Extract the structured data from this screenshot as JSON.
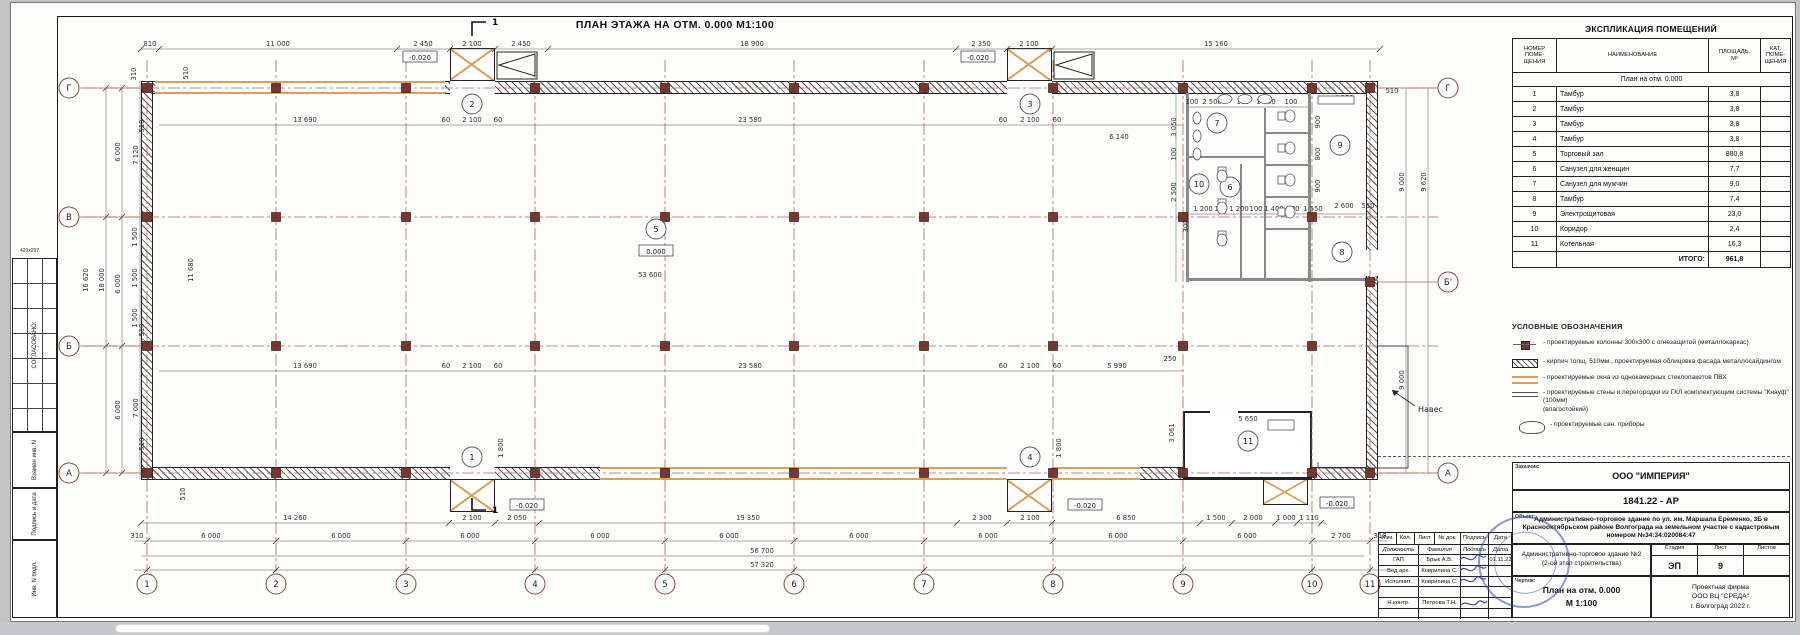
{
  "sheet": {
    "title": "ПЛАН ЭТАЖА НА ОТМ. 0.000   М1:100"
  },
  "margin_stamps": {
    "soglasovano": "СОГЛАСОВАНО:",
    "paper": "420х297",
    "vzamen": "Взамен инв. N",
    "podpis_data": "Подпись и дата",
    "inv_podl": "Инв. N подл."
  },
  "schedule": {
    "title": "ЭКСПЛИКАЦИЯ ПОМЕЩЕНИЙ",
    "col_num": "НОМЕР\nПОМЕ-\nЩЕНИЯ",
    "col_name": "НАИМЕНОВАНИЕ",
    "col_area": "ПЛОЩАДЬ,\nМ²",
    "col_cat": "КАТ.\nПОМЕ-\nЩЕНИЯ",
    "subheader": "План на отм. 0.000",
    "rows": [
      [
        "1",
        "Тамбур",
        "3,8"
      ],
      [
        "2",
        "Тамбур",
        "3,8"
      ],
      [
        "3",
        "Тамбур",
        "3,8"
      ],
      [
        "4",
        "Тамбур",
        "3,8"
      ],
      [
        "5",
        "Торговый зал",
        "880,8"
      ],
      [
        "6",
        "Санузел для женщин",
        "7,7"
      ],
      [
        "7",
        "Санузел для мужчин",
        "9,0"
      ],
      [
        "8",
        "Тамбур",
        "7,4"
      ],
      [
        "9",
        "Электрощитовая",
        "23,0"
      ],
      [
        "10",
        "Коридор",
        "2,4"
      ],
      [
        "11",
        "Котельная",
        "16,3"
      ]
    ],
    "total_label": "ИТОГО:",
    "total_value": "961,8"
  },
  "legend": {
    "title": "УСЛОВНЫЕ ОБОЗНАЧЕНИЯ",
    "items": [
      {
        "icon": "icon-column-symbol",
        "text": "- проектируемые колонны 300х300 с огнезащитой (металлокаркас)"
      },
      {
        "icon": "icon-brick-wall-symbol",
        "text": "- кирпич толщ. 510мм., проектируемая облицовка фасада металлосайдингом"
      },
      {
        "icon": "icon-window-symbol",
        "text": "- проектируемые окна из однокамерных стеклопакетов ПВХ"
      },
      {
        "icon": "icon-gkl-wall-symbol",
        "text": "- проектируемые стены и перегородки из ГКЛ комплектующим системы \"Кнауф\" (100мм)\n(влагостойкий)"
      },
      {
        "icon": "icon-sanitary-symbol",
        "text": "- проектируемые сан. приборы"
      }
    ]
  },
  "titleblock": {
    "customer_label": "Заказчик:",
    "customer": "ООО \"ИМПЕРИЯ\"",
    "doc_number": "1841.22 - АР",
    "object_label": "Объект:",
    "object": "Административно-торговое здание по ул. им. Маршала Еременко, 3Б в Краснооктябрьском районе Волгограда на земельном участке с кадастровым номером №34:34:020084:47",
    "building": "Административно-торговое здание №2",
    "building2": "(2-ой этап строительства)",
    "stage_label": "Стадия",
    "sheet_label": "Лист",
    "sheets_label": "Листов",
    "stage": "ЭП",
    "sheet_no": "9",
    "sheets_no": "",
    "drawing_label": "Чертеж:",
    "drawing": "План на отм. 0.000",
    "drawing_scale": "М 1:100",
    "firm1": "Проектная фирма",
    "firm2": "ООО ВЦ \"СРЕДА\"",
    "firm3": "г. Волгоград 2022 г.",
    "cols": [
      "Изм.",
      "Кол.",
      "Лист",
      "№ док.",
      "Подпись",
      "Дата"
    ],
    "roles_header": [
      "Должность",
      "Фамилия",
      "Подпись",
      "Дата"
    ],
    "rows": [
      [
        "ГАП",
        "Брык А.В.",
        "01.11.22"
      ],
      [
        "Вед.арх.",
        "Коврипина С.",
        ""
      ],
      [
        "Исполнит.",
        "Коврипина С.",
        ""
      ],
      [
        "",
        "",
        ""
      ],
      [
        "Н.контр.",
        "Петрова Т.Н.",
        ""
      ],
      [
        "",
        "",
        ""
      ]
    ]
  },
  "plan": {
    "section_mark": "1",
    "canopy_label": "Навес",
    "axes_bottom": [
      [
        "1",
        147
      ],
      [
        "2",
        276
      ],
      [
        "3",
        406
      ],
      [
        "4",
        535
      ],
      [
        "5",
        665
      ],
      [
        "6",
        794
      ],
      [
        "7",
        924
      ],
      [
        "8",
        1053
      ],
      [
        "9",
        1183
      ],
      [
        "10",
        1312
      ],
      [
        "11",
        1370
      ]
    ],
    "rows_left": [
      [
        "Г",
        88
      ],
      [
        "В",
        217
      ],
      [
        "Б",
        346
      ],
      [
        "А",
        473
      ]
    ],
    "rows_right": [
      [
        "Г",
        88
      ],
      [
        "Б'",
        282
      ],
      [
        "А",
        473
      ]
    ],
    "rooms": [
      [
        "1",
        472,
        457
      ],
      [
        "2",
        472,
        104
      ],
      [
        "3",
        1030,
        104
      ],
      [
        "4",
        1030,
        457
      ],
      [
        "5",
        656,
        229
      ],
      [
        "6",
        1230,
        187
      ],
      [
        "7",
        1217,
        123
      ],
      [
        "8",
        1342,
        252
      ],
      [
        "9",
        1340,
        145
      ],
      [
        "10",
        1199,
        184
      ],
      [
        "11",
        1248,
        441
      ]
    ],
    "levels": [
      [
        "0.000",
        656,
        251
      ],
      [
        "-0.020",
        420,
        57
      ],
      [
        "-0.020",
        978,
        57
      ],
      [
        "-0.020",
        527,
        505
      ],
      [
        "-0.020",
        1085,
        505
      ],
      [
        "-0.020",
        1337,
        503
      ]
    ],
    "dims": [
      [
        "810",
        150,
        46,
        0
      ],
      [
        "11 000",
        278,
        46,
        0
      ],
      [
        "2 450",
        423,
        46,
        0
      ],
      [
        "2 100",
        472,
        46,
        0
      ],
      [
        "2 450",
        521,
        46,
        0
      ],
      [
        "18 900",
        752,
        46,
        0
      ],
      [
        "2 350",
        981,
        46,
        0
      ],
      [
        "2 100",
        1029,
        46,
        0
      ],
      [
        "15 160",
        1216,
        46,
        0
      ],
      [
        "4 250",
        1344,
        100,
        0
      ],
      [
        "510",
        1392,
        93,
        0
      ],
      [
        "100",
        1192,
        104,
        0
      ],
      [
        "2 500",
        1212,
        104,
        0
      ],
      [
        "100",
        1243,
        104,
        0
      ],
      [
        "1 400",
        1266,
        104,
        0
      ],
      [
        "100",
        1291,
        104,
        0
      ],
      [
        "9 000",
        1404,
        182,
        1
      ],
      [
        "9 620",
        1426,
        182,
        1
      ],
      [
        "9 000",
        1404,
        380,
        1
      ],
      [
        "3 050",
        1176,
        127,
        1
      ],
      [
        "100",
        1176,
        154,
        1
      ],
      [
        "2 500",
        1176,
        192,
        1
      ],
      [
        "300",
        1188,
        226,
        1
      ],
      [
        "900",
        1320,
        122,
        1
      ],
      [
        "800",
        1320,
        154,
        1
      ],
      [
        "900",
        1320,
        186,
        1
      ],
      [
        "2 600",
        1344,
        208,
        0
      ],
      [
        "510",
        1368,
        208,
        0
      ],
      [
        "1 200",
        1203,
        211,
        0
      ],
      [
        "100",
        1221,
        211,
        0
      ],
      [
        "1 200",
        1239,
        211,
        0
      ],
      [
        "100",
        1256,
        211,
        0
      ],
      [
        "1 400",
        1274,
        211,
        0
      ],
      [
        "100",
        1293,
        211,
        0
      ],
      [
        "1 550",
        1313,
        211,
        0
      ],
      [
        "13 690",
        305,
        122,
        0
      ],
      [
        "60",
        446,
        122,
        0
      ],
      [
        "2 100",
        472,
        122,
        0
      ],
      [
        "60",
        498,
        122,
        0
      ],
      [
        "23 580",
        750,
        122,
        0
      ],
      [
        "60",
        1003,
        122,
        0
      ],
      [
        "2 100",
        1030,
        122,
        0
      ],
      [
        "60",
        1057,
        122,
        0
      ],
      [
        "6 140",
        1119,
        139,
        0
      ],
      [
        "53 600",
        650,
        277,
        0
      ],
      [
        "11 680",
        193,
        270,
        1
      ],
      [
        "510",
        188,
        73,
        1
      ],
      [
        "13 690",
        305,
        368,
        0
      ],
      [
        "60",
        446,
        368,
        0
      ],
      [
        "2 100",
        472,
        368,
        0
      ],
      [
        "60",
        498,
        368,
        0
      ],
      [
        "23 580",
        750,
        368,
        0
      ],
      [
        "60",
        1003,
        368,
        0
      ],
      [
        "2 100",
        1030,
        368,
        0
      ],
      [
        "60",
        1057,
        368,
        0
      ],
      [
        "5 990",
        1117,
        368,
        0
      ],
      [
        "250",
        1170,
        361,
        0
      ],
      [
        "5 650",
        1248,
        421,
        0
      ],
      [
        "3 061",
        1174,
        433,
        1
      ],
      [
        "1 800",
        503,
        448,
        1
      ],
      [
        "1 800",
        1061,
        448,
        1
      ],
      [
        "510",
        185,
        494,
        1
      ],
      [
        "310",
        136,
        74,
        1
      ],
      [
        "510",
        144,
        126,
        1
      ],
      [
        "6 000",
        120,
        152,
        1
      ],
      [
        "7 120",
        138,
        155,
        1
      ],
      [
        "1 500",
        137,
        237,
        1
      ],
      [
        "1 500",
        137,
        278,
        1
      ],
      [
        "1 500",
        137,
        318,
        1
      ],
      [
        "16 620",
        88,
        280,
        1
      ],
      [
        "18 000",
        104,
        280,
        1
      ],
      [
        "6 000",
        120,
        284,
        1
      ],
      [
        "6 000",
        120,
        410,
        1
      ],
      [
        "7 000",
        138,
        408,
        1
      ],
      [
        "510",
        144,
        330,
        1
      ],
      [
        "510",
        144,
        444,
        1
      ],
      [
        "14 260",
        295,
        520,
        0
      ],
      [
        "2 100",
        472,
        520,
        0
      ],
      [
        "2 050",
        517,
        520,
        0
      ],
      [
        "19 350",
        748,
        520,
        0
      ],
      [
        "2 300",
        982,
        520,
        0
      ],
      [
        "2 100",
        1030,
        520,
        0
      ],
      [
        "6 850",
        1126,
        520,
        0
      ],
      [
        "1 500",
        1216,
        520,
        0
      ],
      [
        "2 000",
        1253,
        520,
        0
      ],
      [
        "1 000",
        1286,
        520,
        0
      ],
      [
        "1 110",
        1309,
        520,
        0
      ],
      [
        "310",
        137,
        538,
        0
      ],
      [
        "6 000",
        211,
        538,
        0
      ],
      [
        "6 000",
        341,
        538,
        0
      ],
      [
        "6 000",
        470,
        538,
        0
      ],
      [
        "6 000",
        600,
        538,
        0
      ],
      [
        "6 000",
        729,
        538,
        0
      ],
      [
        "6 000",
        859,
        538,
        0
      ],
      [
        "6 000",
        988,
        538,
        0
      ],
      [
        "6 000",
        1118,
        538,
        0
      ],
      [
        "6 000",
        1247,
        538,
        0
      ],
      [
        "2 700",
        1341,
        538,
        0
      ],
      [
        "310",
        1380,
        538,
        0
      ],
      [
        "56 700",
        762,
        553,
        0
      ],
      [
        "57 320",
        762,
        567,
        0
      ]
    ]
  },
  "colors": {
    "axis": "#ab6558",
    "window_accent": "#dd9e57",
    "column_fill": "#7c352b",
    "stamp_blue": "#3448a8"
  }
}
